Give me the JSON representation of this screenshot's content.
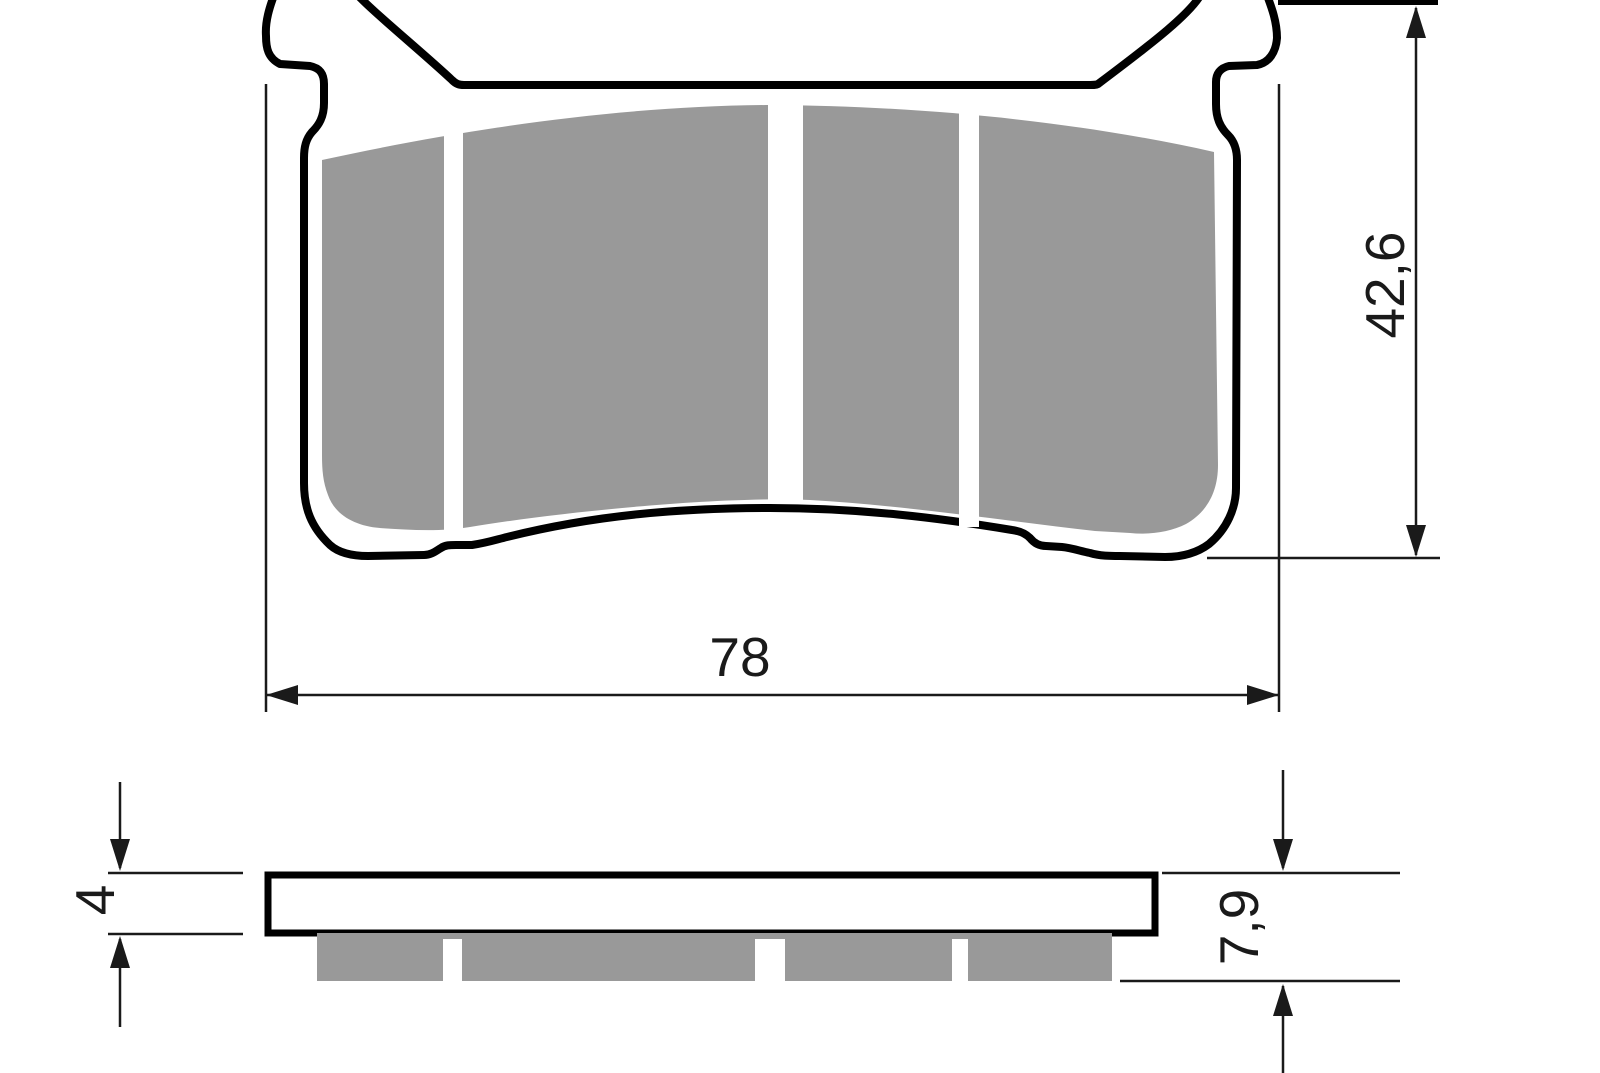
{
  "drawing": {
    "type": "brake-pad-technical-drawing",
    "views": {
      "front": "pad-front-profile",
      "side": "pad-side-profile"
    },
    "colors": {
      "outline": "#000000",
      "friction_material": "#999999",
      "background": "#ffffff",
      "dimension_lines": "#1a1a1a"
    },
    "dimensions": {
      "width": {
        "value": "78"
      },
      "height": {
        "value": "42,6"
      },
      "backplate_thickness": {
        "value": "4"
      },
      "total_thickness": {
        "value": "7,9"
      }
    }
  }
}
